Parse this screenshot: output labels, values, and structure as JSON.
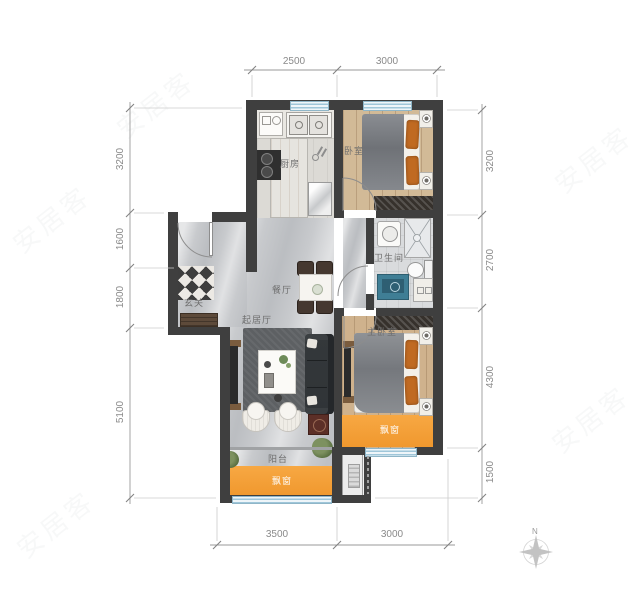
{
  "rooms": {
    "kitchen": "厨房",
    "bedroom": "卧室",
    "bathroom": "卫生间",
    "dining": "餐厅",
    "foyer": "玄关",
    "living": "起居厅",
    "master_bedroom": "主卧室",
    "balcony": "阳台",
    "bay_window_master": "飘窗",
    "bay_window_balcony": "飘窗"
  },
  "dimensions": {
    "top": [
      "2500",
      "3000"
    ],
    "bottom": [
      "3500",
      "3000"
    ],
    "left": [
      "3200",
      "1600",
      "1800",
      "5100"
    ],
    "right": [
      "3200",
      "2700",
      "4300",
      "1500"
    ]
  },
  "compass": {
    "north": "N"
  },
  "watermark": "安居客",
  "colors": {
    "wall": "#3f3f3f",
    "bay_window": "#f6a33c",
    "wood_floor": "#d2ba97",
    "marble_floor": "#c8cacd",
    "window_glass": "#9fc6d9",
    "dimension_text": "#8a8a8a",
    "room_label_text": "#6e6e6e"
  }
}
